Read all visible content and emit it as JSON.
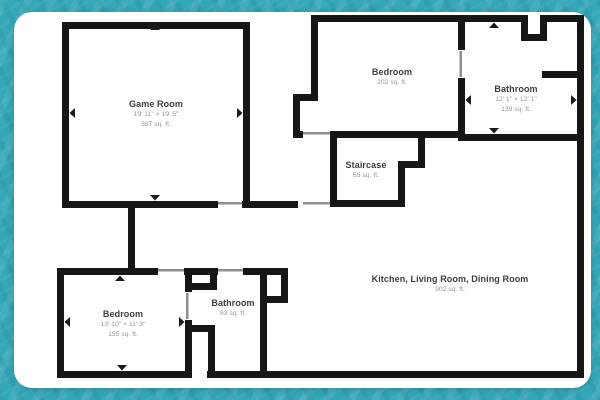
{
  "app": {
    "background_color": "#34a7b8",
    "card_color": "#ffffff",
    "wall_color": "#161616",
    "door_line_color": "#8f8f8f"
  },
  "floor_plan": {
    "rooms": [
      {
        "id": "game-room",
        "name": "Game Room",
        "dimensions": "19' 11\" × 19' 5\"",
        "area": "387 sq. ft.",
        "has_dimension_arrows": true
      },
      {
        "id": "bedroom-upper",
        "name": "Bedroom",
        "dimensions": "",
        "area": "202 sq. ft.",
        "has_dimension_arrows": false
      },
      {
        "id": "bathroom-upper",
        "name": "Bathroom",
        "dimensions": "12' 1\" × 12' 1\"",
        "area": "139 sq. ft.",
        "has_dimension_arrows": true
      },
      {
        "id": "staircase",
        "name": "Staircase",
        "dimensions": "",
        "area": "55 sq. ft.",
        "has_dimension_arrows": false
      },
      {
        "id": "kitchen-living-dining",
        "name": "Kitchen, Living Room, Dining Room",
        "dimensions": "",
        "area": "902 sq. ft.",
        "has_dimension_arrows": false
      },
      {
        "id": "bedroom-lower",
        "name": "Bedroom",
        "dimensions": "13' 10\" × 11' 3\"",
        "area": "155 sq. ft.",
        "has_dimension_arrows": true
      },
      {
        "id": "bathroom-lower",
        "name": "Bathroom",
        "dimensions": "",
        "area": "63 sq. ft.",
        "has_dimension_arrows": false
      }
    ]
  }
}
